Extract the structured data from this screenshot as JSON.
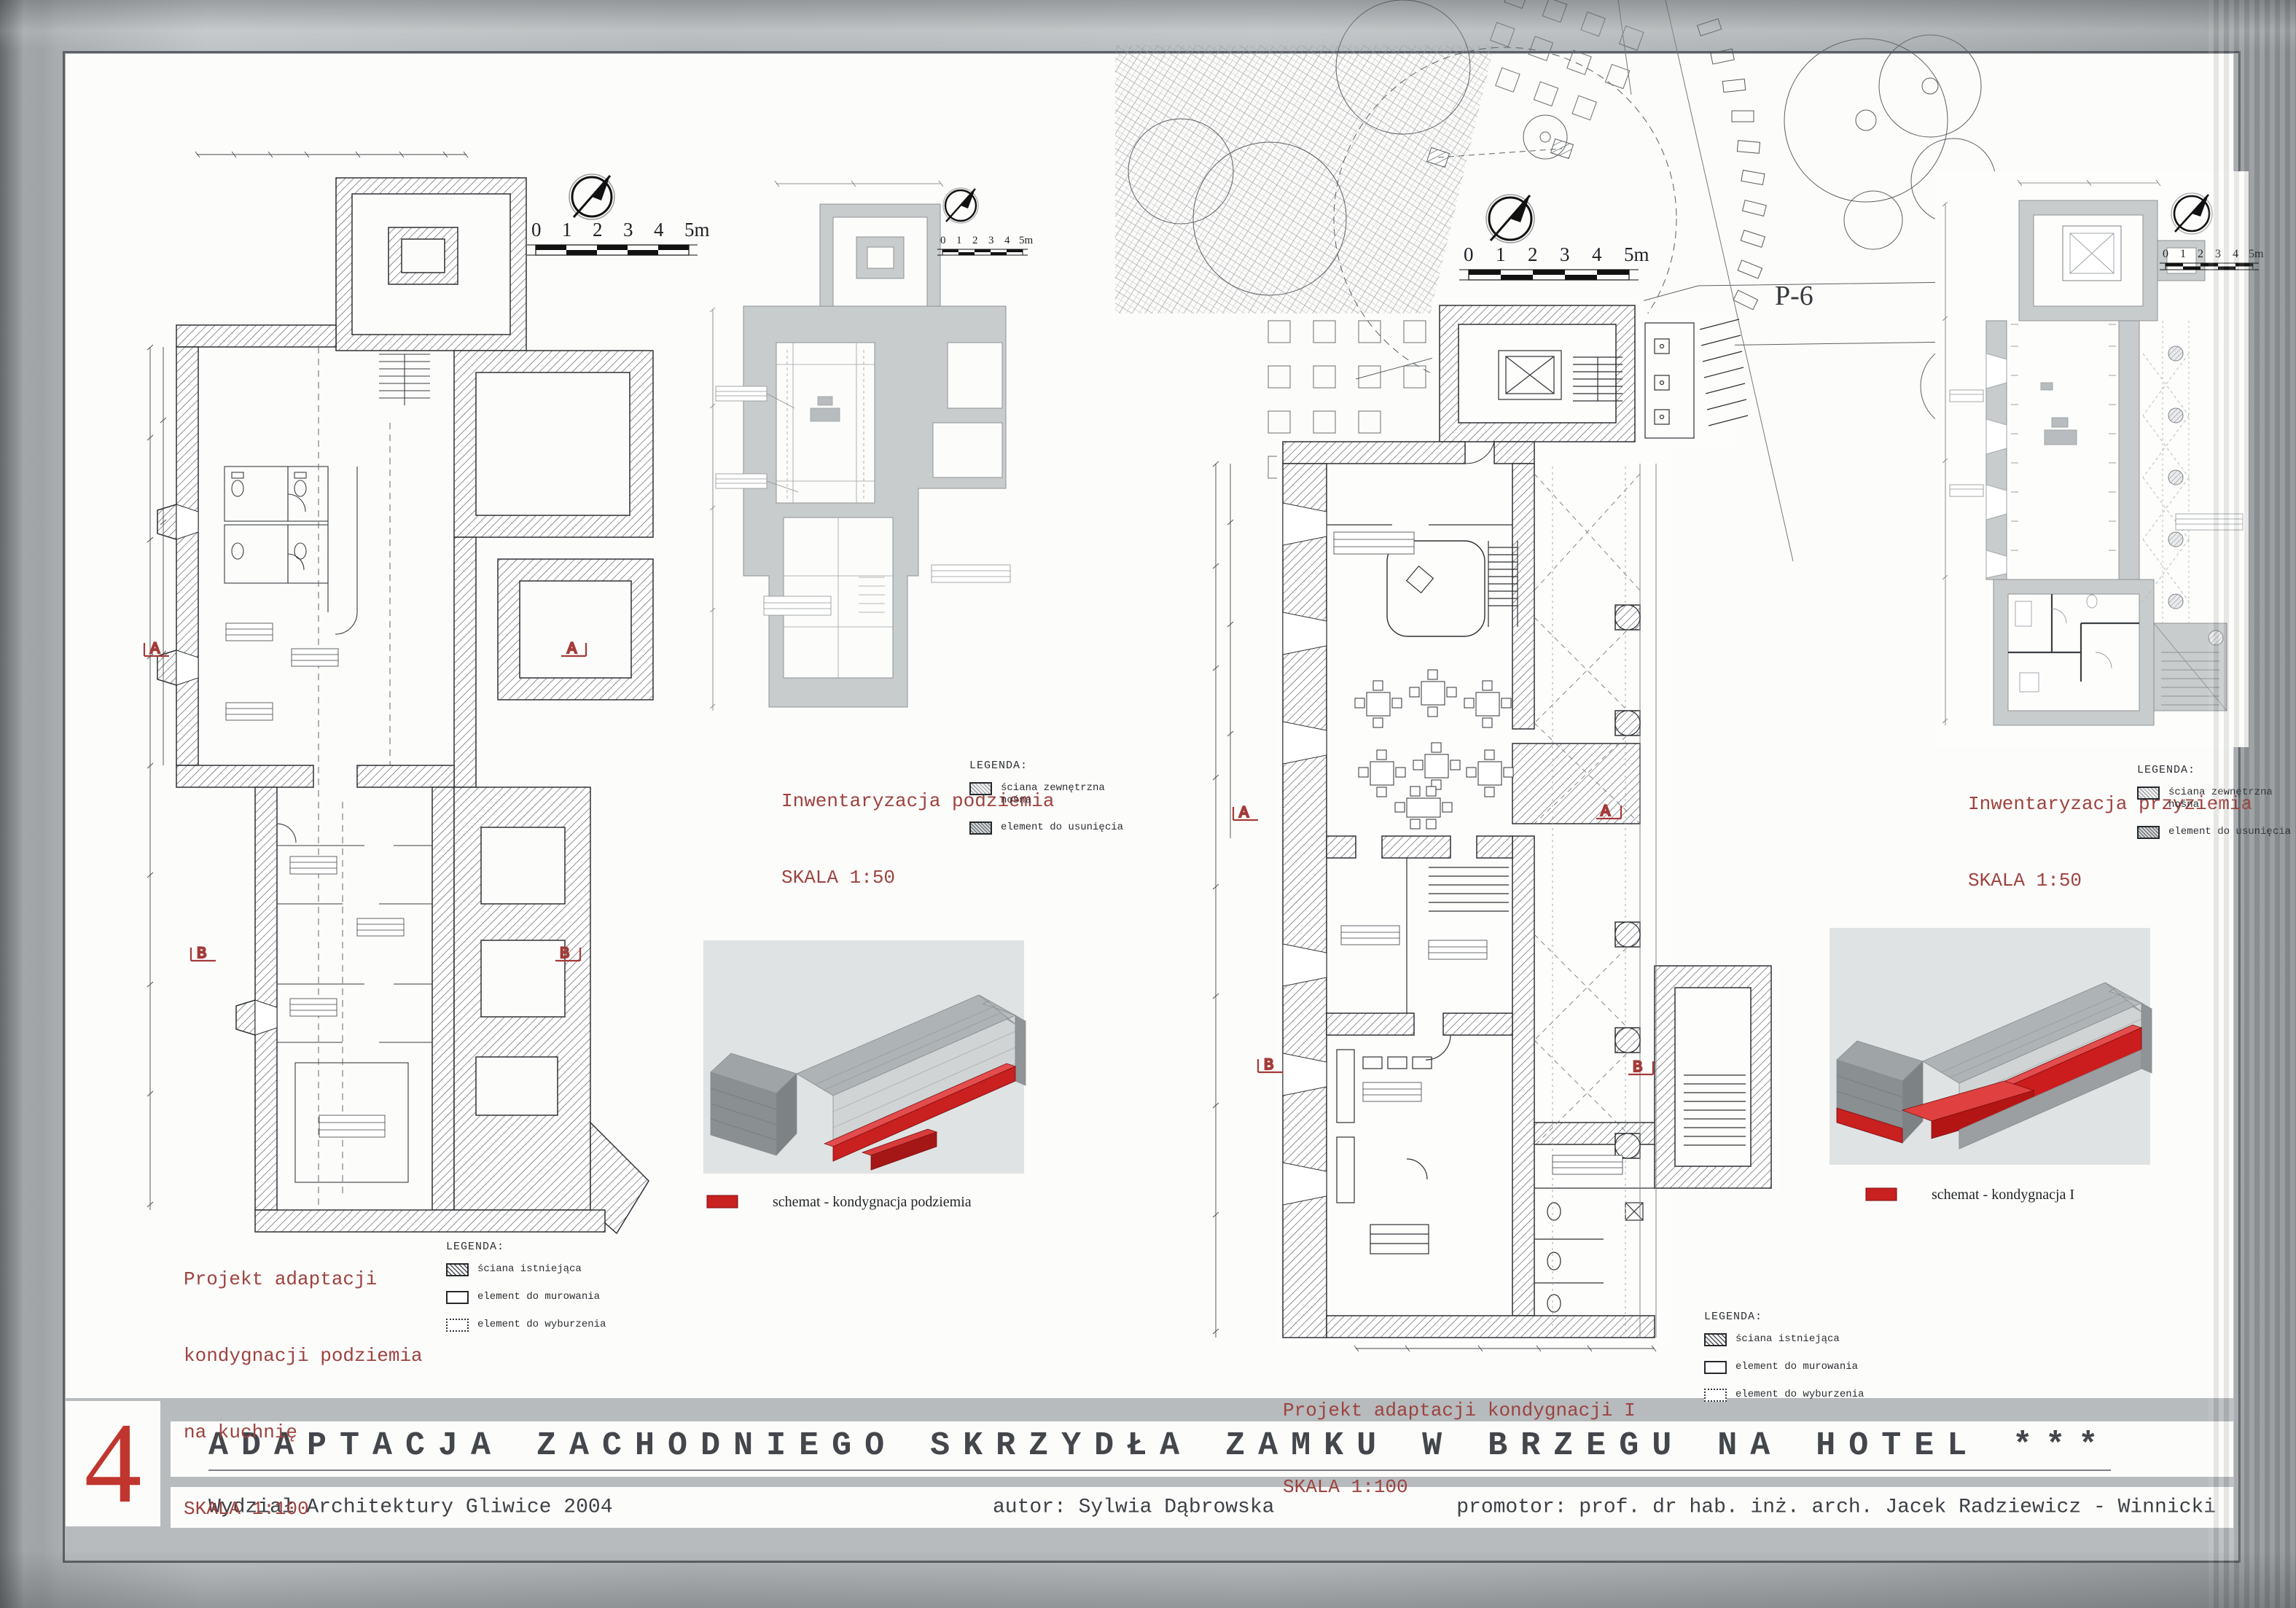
{
  "board": {
    "plate_number": "4",
    "title": "ADAPTACJA ZACHODNIEGO SKRZYDŁA ZAMKU W BRZEGU NA HOTEL ***",
    "faculty": "Wydział Architektury  Gliwice 2004",
    "author_label": "autor: Sylwia Dąbrowska",
    "promoter_label": "promotor: prof. dr hab. inż. arch. Jacek Radziewicz - Winnicki"
  },
  "scalebar": {
    "labels": [
      "0",
      "1",
      "2",
      "3",
      "4",
      "5m"
    ]
  },
  "site": {
    "area_label": "P-6"
  },
  "sections": {
    "a": "A",
    "b": "B"
  },
  "left": {
    "plan_caption": {
      "l1": "Projekt adaptacji",
      "l2": "kondygnacji podziemia",
      "l3": "na kuchnię",
      "scale": "SKALA 1:100"
    },
    "legend": {
      "heading": "LEGENDA:",
      "items": [
        {
          "label": "ściana istniejąca",
          "swatch": "hatch"
        },
        {
          "label": "element do murowania",
          "swatch": "outline"
        },
        {
          "label": "element do wyburzenia",
          "swatch": "dotted"
        }
      ]
    },
    "inventory": {
      "title": "Inwentaryzacja podziemia",
      "scale": "SKALA 1:50"
    },
    "inv_legend": {
      "heading": "LEGENDA:",
      "item1a": "ściana zewnętrzna",
      "item1b": "nośna",
      "item2": "element do usunięcia"
    },
    "schematic": "schemat - kondygnacja podziemia"
  },
  "right": {
    "plan_caption": {
      "l1": "Projekt adaptacji kondygnacji I",
      "scale": "SKALA 1:100"
    },
    "legend": {
      "heading": "LEGENDA:",
      "items": [
        {
          "label": "ściana istniejąca",
          "swatch": "hatch"
        },
        {
          "label": "element do murowania",
          "swatch": "outline"
        },
        {
          "label": "element do wyburzenia",
          "swatch": "dotted"
        }
      ]
    },
    "inventory": {
      "title": "Inwentaryzacja przyziemia",
      "scale": "SKALA 1:50"
    },
    "inv_legend": {
      "heading": "LEGENDA:",
      "item1a": "ściana zewnętrzna",
      "item1b": "nośna",
      "item2": "element do usunięcia"
    },
    "schematic": "schemat - kondygnacja I"
  },
  "colors": {
    "accent_red": "#a33b38",
    "numeral_red": "#c0362e",
    "schematic_red": "#c92020",
    "caption_red": "#9c4340",
    "board_white": "#fcfcfa",
    "metal_grey": "#b4b8ba"
  }
}
